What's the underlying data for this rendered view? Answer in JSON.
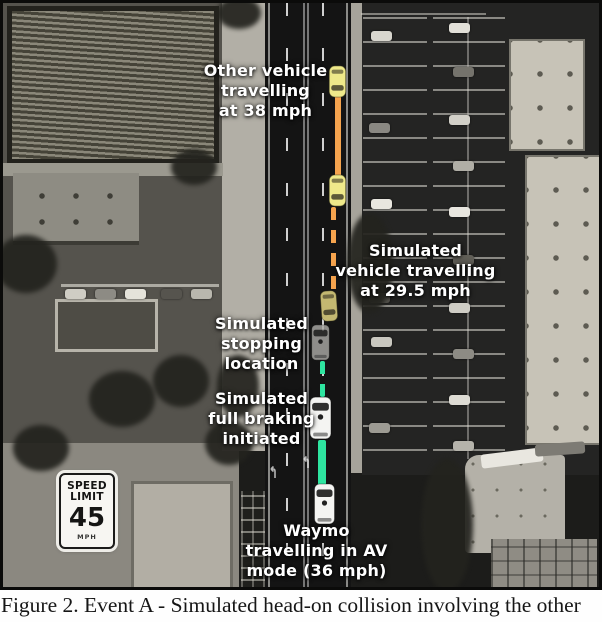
{
  "caption": "Figure 2. Event A - Simulated head-on collision involving the other",
  "annotations": {
    "other_vehicle": {
      "lines": [
        "Other vehicle",
        "travelling",
        "at 38 mph"
      ]
    },
    "simulated_vehicle": {
      "lines": [
        "Simulated",
        "vehicle travelling",
        "at 29.5 mph"
      ]
    },
    "stopping_location": {
      "lines": [
        "Simulated",
        "stopping",
        "location"
      ]
    },
    "full_braking": {
      "lines": [
        "Simulated",
        "full braking",
        "initiated"
      ]
    },
    "waymo": {
      "lines": [
        "Waymo",
        "travelling in AV",
        "mode (36 mph)"
      ]
    }
  },
  "speed_limit_sign": {
    "line1": "SPEED",
    "line2": "LIMIT",
    "value": "45",
    "unit": "MPH"
  },
  "colors": {
    "path_orange": "#F6A44E",
    "path_green": "#2EE5A0",
    "car_yellow": "#EFE98A",
    "car_yellow_dim": "#CDC176",
    "van_gray": "#A9A8A4",
    "van_white": "#F4F4F2",
    "label_text": "#FFFFFF"
  }
}
